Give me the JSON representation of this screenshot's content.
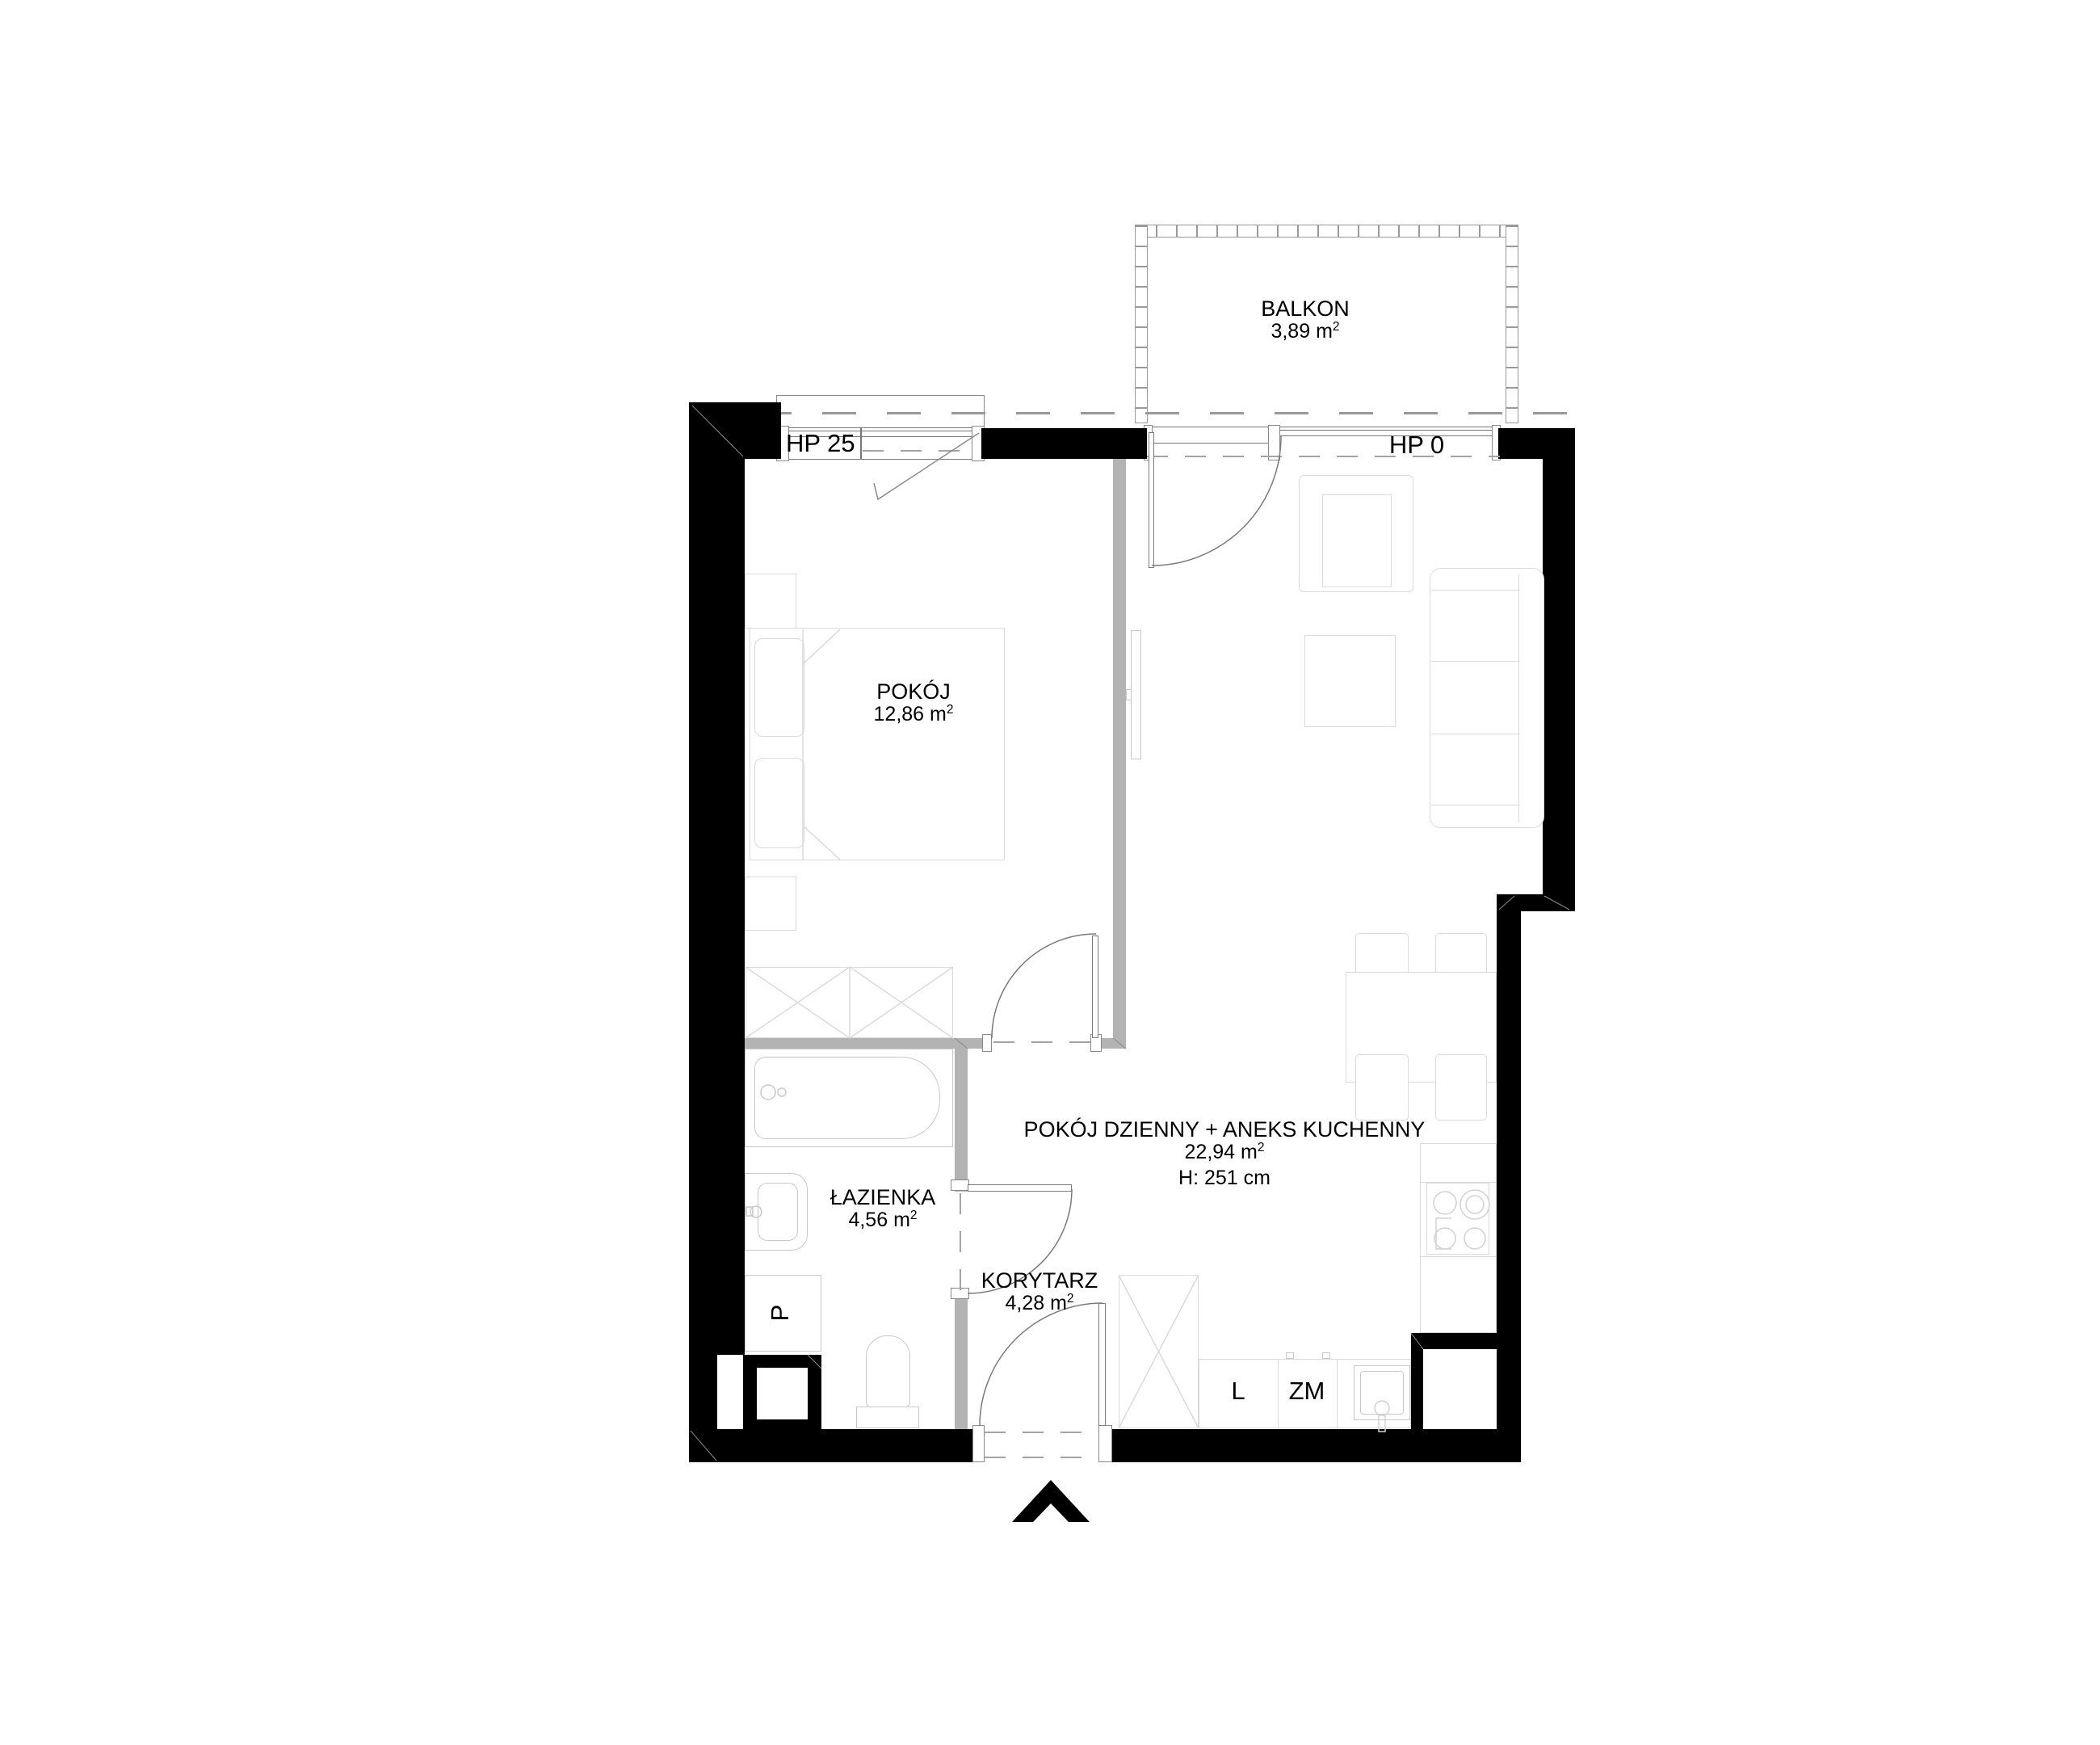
{
  "title": "apartment floor plan",
  "rooms": {
    "balkon": {
      "name": "BALKON",
      "area": "3,89 m",
      "exp": "2"
    },
    "pokoj": {
      "name": "POKÓJ",
      "area": "12,86 m",
      "exp": "2"
    },
    "living": {
      "name": "POKÓJ DZIENNY + ANEKS KUCHENNY",
      "area": "22,94 m",
      "exp": "2",
      "height": "H: 251 cm"
    },
    "lazienka": {
      "name": "ŁAZIENKA",
      "area": "4,56 m",
      "exp": "2"
    },
    "korytarz": {
      "name": "KORYTARZ",
      "area": "4,28 m",
      "exp": "2"
    }
  },
  "windows": {
    "hp25": "HP 25",
    "hp0": "HP 0"
  },
  "appliances": {
    "fridge": "L",
    "dishwasher": "ZM",
    "washer": "P"
  },
  "colors": {
    "wall": "#000000",
    "partition": "#b3b3b3",
    "furniture_line": "#dadada",
    "fixture_line": "#c9c9c9",
    "dash_line": "#999999",
    "arc_line": "#7a7a7a"
  }
}
